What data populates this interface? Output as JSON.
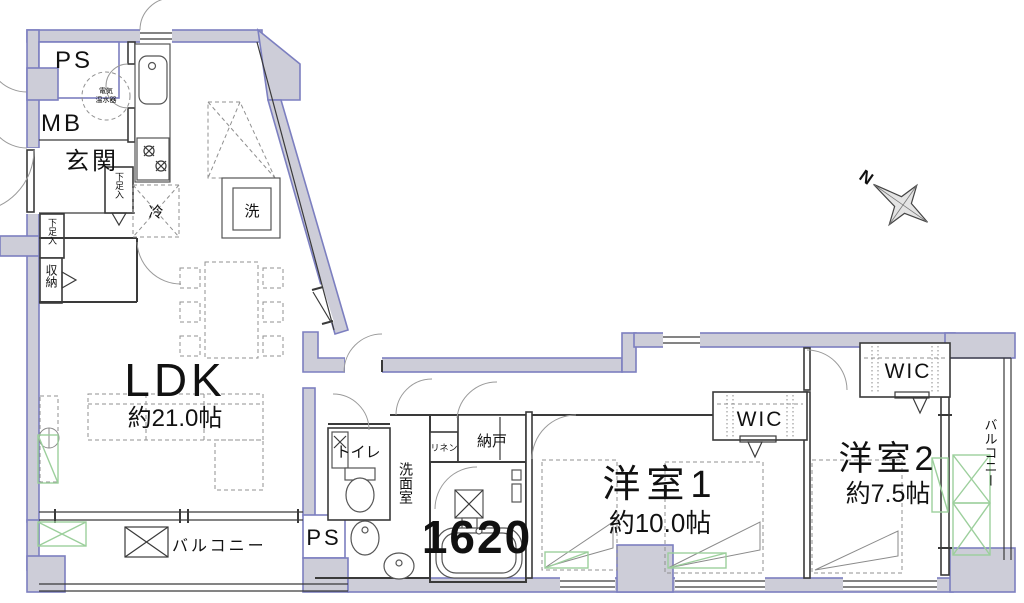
{
  "plan": {
    "service": {
      "ps_top": "PS",
      "mb": "MB",
      "ps_bottom": "PS"
    },
    "entrance": {
      "label": "玄関",
      "shoe_cabinet_1": "下足入",
      "shoe_cabinet_2": "下足入",
      "storage": "収納"
    },
    "kitchen": {
      "fridge": "冷",
      "washer": "洗",
      "water_heater_line1": "電気",
      "water_heater_line2": "温水器"
    },
    "ldk": {
      "label": "LDK",
      "size": "約21.0帖"
    },
    "sanitary": {
      "toilet": "トイレ",
      "washroom": "洗面室",
      "linen": "リネン",
      "storeroom": "納戸",
      "bath_size": "1620"
    },
    "bedroom1": {
      "label": "洋室1",
      "size": "約10.0帖",
      "wic": "WIC"
    },
    "bedroom2": {
      "label": "洋室2",
      "size": "約7.5帖",
      "wic": "WIC"
    },
    "balconies": {
      "left": "バルコニー",
      "right": "バルコニー"
    },
    "compass": {
      "north": "N"
    }
  },
  "colors": {
    "wall_fill": "#cdcdd8",
    "wall_stroke": "#7c7fc0",
    "line": "#3a3a3a",
    "furniture": "#909090",
    "accent_green": "#9ccf9c",
    "text": "#111111"
  }
}
